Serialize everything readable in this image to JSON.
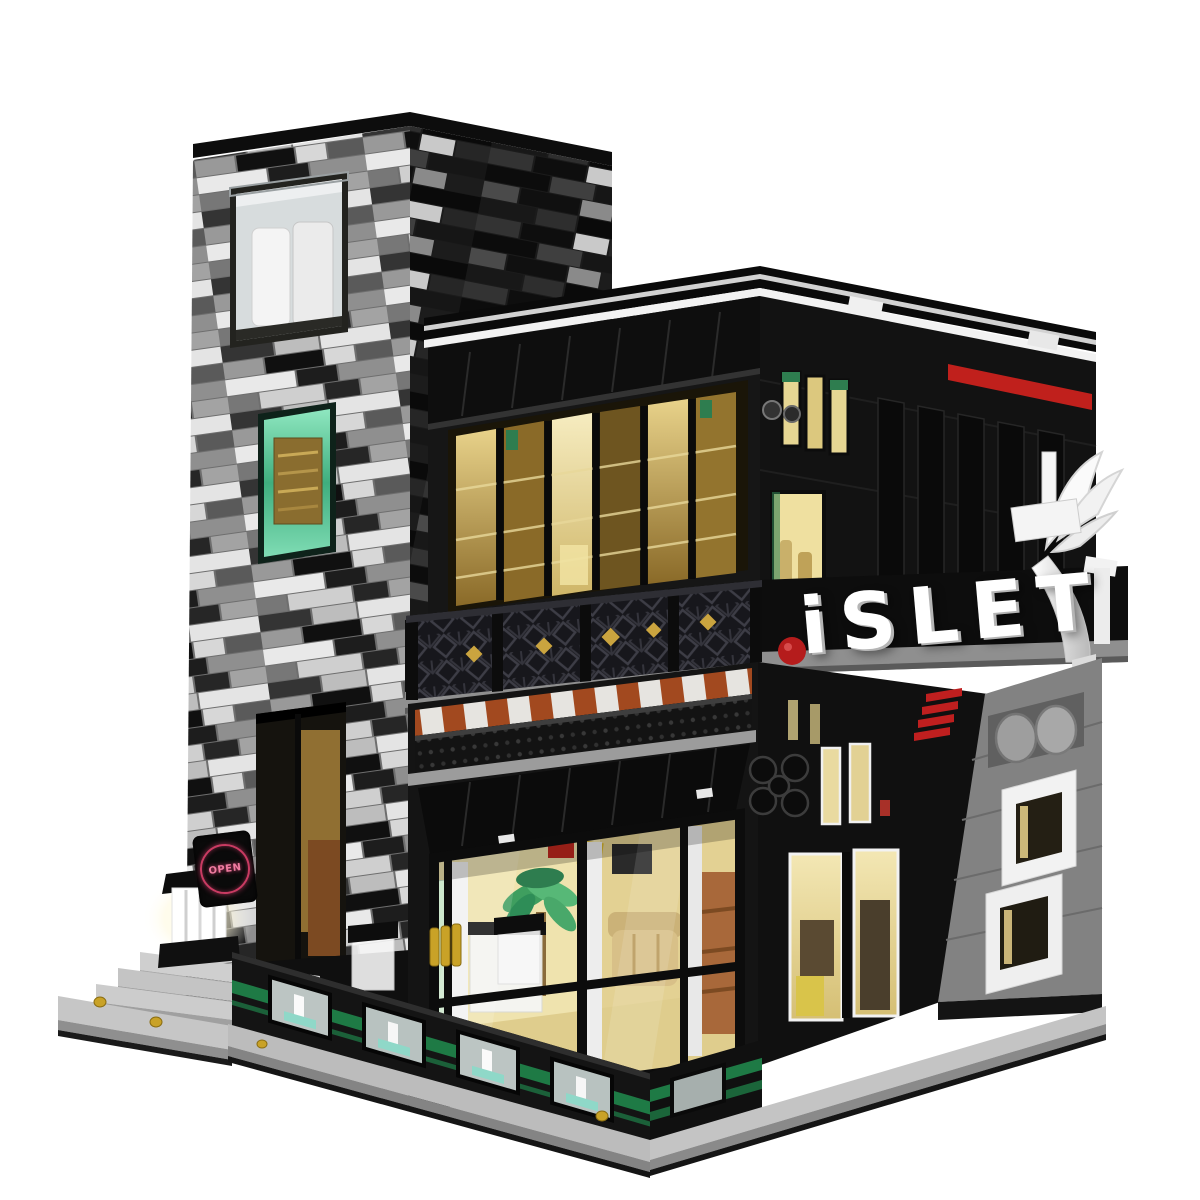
{
  "scene": {
    "description": "Product photo on white background: brick-built modular building model of a two-storey modern pub/cafe with a tall greyscale masonry corner tower, warm-lit interiors, balcony and terrace",
    "background_color": "#ffffff"
  },
  "signs": {
    "main": "iSLET",
    "main_color": "#ffffff",
    "main_dot_color": "#b51c1c",
    "open": "OPEN",
    "open_color": "#ef7ca0",
    "open_ring_color": "#c93b62"
  },
  "colors": {
    "black_brick": "#141414",
    "masonry_light": "#adadad",
    "masonry_dark": "#232323",
    "white_trim": "#f2f2f2",
    "amber_glass": "#c9a44e",
    "warm_light": "#efe3ae",
    "teal_glass": "#5fc99a",
    "green_stripe": "#1e7a45",
    "red_accent": "#c0201c",
    "dark_orange_band": "#a2491f",
    "grey_side_wall": "#828282",
    "baseplate_grey": "#bfbfbf",
    "gold_detail": "#c9a227"
  },
  "features": [
    "greyscale random masonry tower with glass display window",
    "teal glass tower window with gold shelf",
    "circular OPEN neon sign",
    "black upper floor with golden bar windows",
    "black lattice balcony railing with gold diamonds",
    "white brick ISLET letter sign with red dot",
    "white angel wing sculpture on corner",
    "red accent stripe and black vertical fins",
    "striped orange-white awning band",
    "lit cafe interior with palm and couch",
    "grey side wall with two white windows and disc vents",
    "black terrace fence with green stripes and glass panels",
    "grey entrance steps with glowing lamp",
    "light grey baseplate"
  ]
}
